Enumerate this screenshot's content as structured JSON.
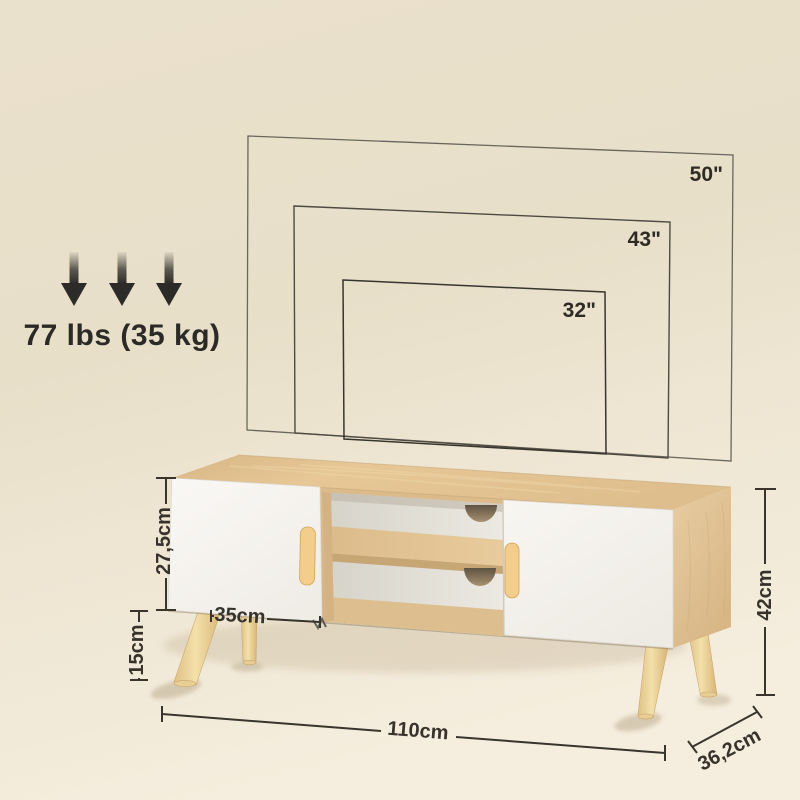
{
  "product_diagram": {
    "title": "tv-stand-dimension-diagram",
    "weight_capacity": {
      "label": "77 lbs (35 kg)",
      "icon": "triple-down-arrow-icon"
    },
    "tv_sizes": [
      {
        "label": "50\""
      },
      {
        "label": "43\""
      },
      {
        "label": "32\""
      }
    ],
    "dimensions": {
      "door_height": {
        "label": "27,5cm"
      },
      "door_width": {
        "label": "35cm"
      },
      "leg_height": {
        "label": "15cm"
      },
      "overall_width": {
        "label": "110cm"
      },
      "overall_height": {
        "label": "42cm"
      },
      "overall_depth": {
        "label": "36,2cm"
      }
    },
    "colors": {
      "background_top": "#E9E0CB",
      "background_floor": "#F4ECDC",
      "wood": "#DFBE8E",
      "wood_light": "#EDD4A6",
      "door_white": "#F8F6F2",
      "handle_wood": "#F2CD8C",
      "annotation": "#39352D"
    }
  }
}
